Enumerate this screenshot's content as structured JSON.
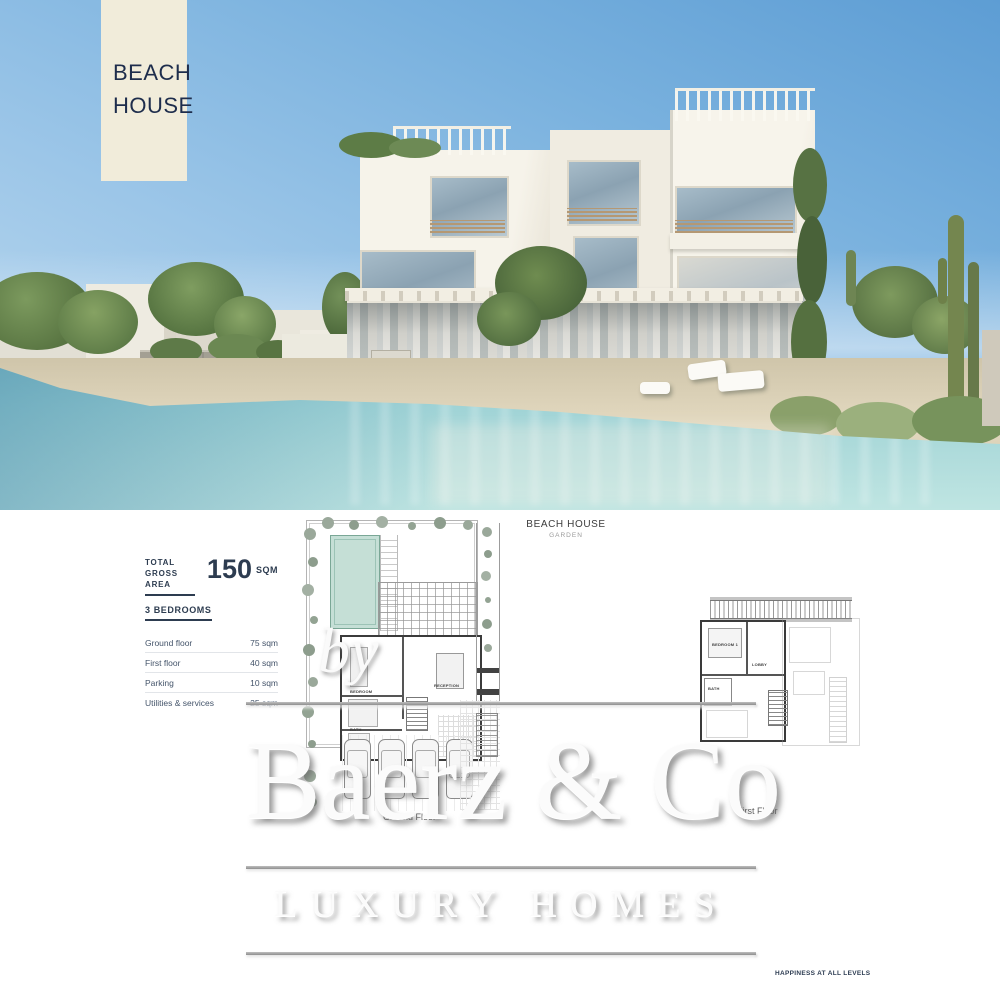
{
  "banner": {
    "line1": "BEACH",
    "line2": "HOUSE"
  },
  "plan_header": {
    "title": "BEACH HOUSE",
    "subtitle": "GARDEN"
  },
  "info": {
    "total_label_line1": "TOTAL",
    "total_label_line2": "GROSS AREA",
    "total_value": "150",
    "total_unit": "SQM",
    "bedrooms": "3 BEDROOMS",
    "rows": [
      {
        "label": "Ground floor",
        "value": "75 sqm"
      },
      {
        "label": "First floor",
        "value": "40 sqm"
      },
      {
        "label": "Parking",
        "value": "10 sqm"
      },
      {
        "label": "Utilities & services",
        "value": "25 sqm"
      }
    ]
  },
  "plans": {
    "ground_label": "Ground Floor",
    "first_label": "First Floor",
    "rooms_ground": [
      "RECEPTION",
      "BEDROOM",
      "BATH"
    ],
    "rooms_first": [
      "BEDROOM 1",
      "LOBBY",
      "BATH"
    ]
  },
  "watermark": {
    "by": "by",
    "brand": "Baerz & Co",
    "tagline": "LUXURY HOMES"
  },
  "footer": {
    "tagline": "HAPPINESS AT ALL LEVELS"
  },
  "colors": {
    "banner_bg": "#f1ecda",
    "navy_text": "#1e2d4c",
    "pool": "#c5dfd6",
    "water": "#9fd3d6",
    "sky": "#79b1de",
    "sand": "#e3d9c0"
  }
}
